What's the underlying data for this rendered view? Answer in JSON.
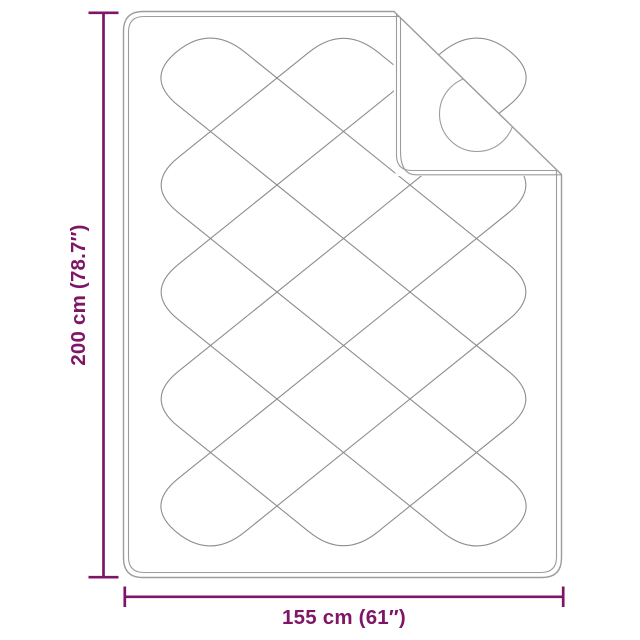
{
  "colors": {
    "accent": "#7e1566",
    "outline_gray": "#9c9c9c",
    "quilt_gray": "#8d8d8d",
    "background": "#ffffff"
  },
  "dimensions": {
    "height": {
      "label": "200 cm (78.7″)",
      "value": "200 cm",
      "inches": "78.7″"
    },
    "width": {
      "label": "155 cm (61″)",
      "value": "155 cm",
      "inches": "61″"
    }
  }
}
